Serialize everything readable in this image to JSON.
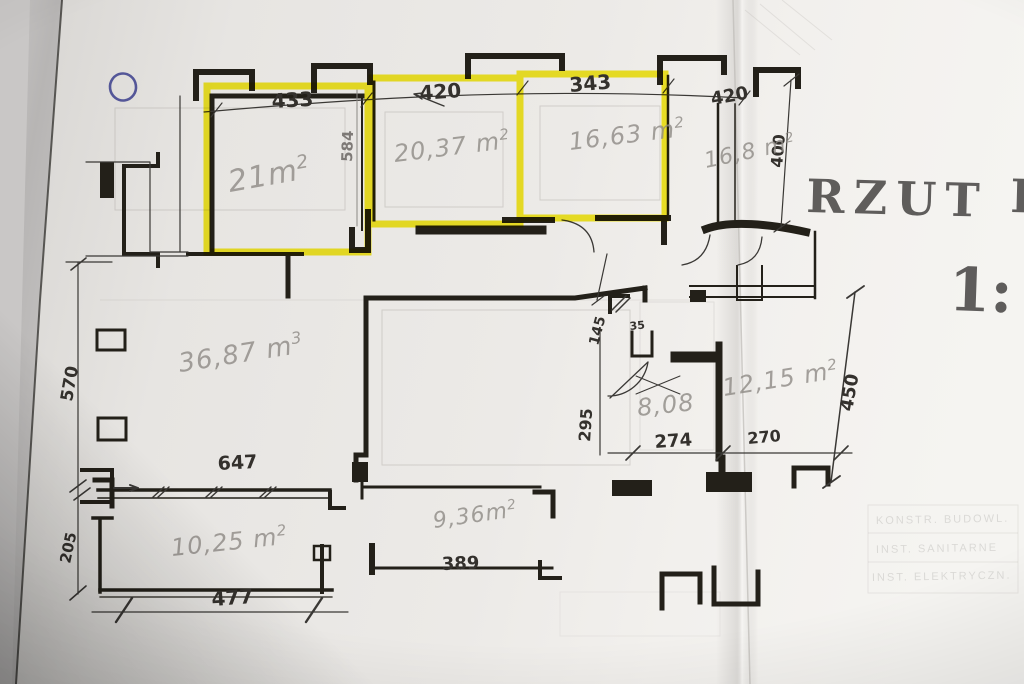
{
  "stamp": {
    "title": "RZUT",
    "partial_letter": "P",
    "scale_prefix": "1:"
  },
  "dimensions": {
    "d433": "433",
    "d420a": "420",
    "d343": "343",
    "d420b": "420",
    "d584": "584",
    "d400": "400",
    "d570": "570",
    "d205": "205",
    "d647": "647",
    "d477": "477",
    "d389": "389",
    "d274": "274",
    "d270": "270",
    "d295": "295",
    "d145": "145",
    "d35": "35",
    "d450": "450"
  },
  "areas": {
    "r1": {
      "v": "21m",
      "sup": "2"
    },
    "r2": {
      "v": "20,37 m",
      "sup": "2"
    },
    "r3": {
      "v": "16,63 m",
      "sup": "2"
    },
    "r4": {
      "v": "16,8 m",
      "sup": "2"
    },
    "vol": {
      "v": "36,87 m",
      "sup": "3"
    },
    "r5": {
      "v": "10,25 m",
      "sup": "2"
    },
    "r6": {
      "v": "9,36m",
      "sup": "2"
    },
    "r7": {
      "v": "8,08",
      "sup": ""
    },
    "r8": {
      "v": "12,15 m",
      "sup": "2"
    }
  },
  "faint_table_rows": {
    "row1": "KONSTR. BUDOWL.",
    "row2": "INST. SANITARNE",
    "row3": "INST. ELEKTRYCZN."
  },
  "colors": {
    "highlight_yellow": "#f6ea00",
    "ink": "#232019",
    "pencil": "#8e8a85",
    "blue_pen": "#3b3e8c",
    "stencil_gray": "#4a4847",
    "paper": "#ece9e6"
  }
}
